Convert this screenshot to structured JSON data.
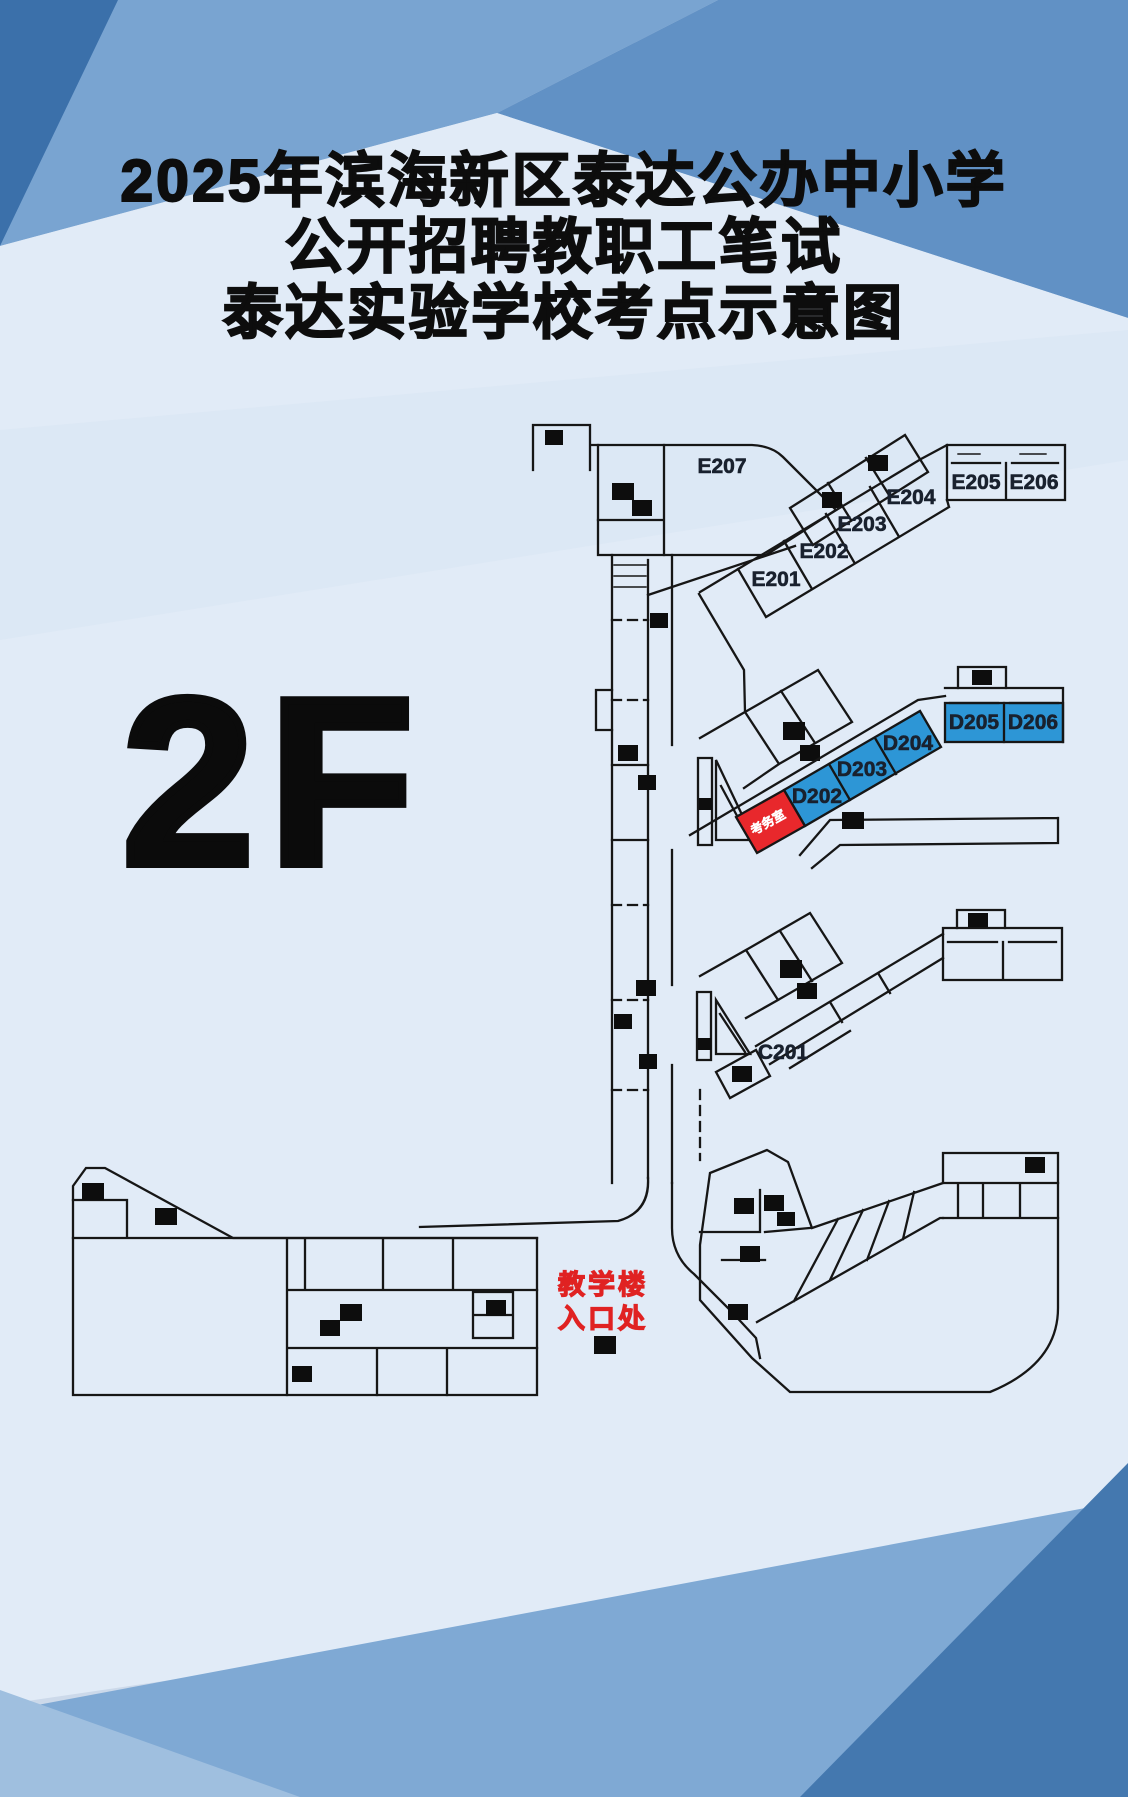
{
  "title": {
    "line1": "2025年滨海新区泰达公办中小学",
    "line2": "公开招聘教职工笔试",
    "line3": "泰达实验学校考点示意图"
  },
  "floor": {
    "label": "2F"
  },
  "map": {
    "rooms": {
      "e201": "E201",
      "e202": "E202",
      "e203": "E203",
      "e204": "E204",
      "e205": "E205",
      "e206": "E206",
      "e207": "E207",
      "c201": "C201",
      "d202": "D202",
      "d203": "D203",
      "d204": "D204",
      "d205": "D205",
      "d206": "D206"
    },
    "exam_office_label": "考务室",
    "entrance": {
      "line1": "教学楼",
      "line2": "入口处"
    }
  },
  "colors": {
    "highlight_room": "#2d96d6",
    "exam_office_room": "#e8282c",
    "entrance_text": "#e02222",
    "wall": "#161616",
    "background": "#ccd9ea",
    "light_area": "#e1ebf7",
    "band_top_left": "#79a4d1",
    "band_top_right": "#6191c5",
    "corner_dark": "#3b70aa",
    "band_bottom": "#7fa9d4",
    "corner_bottom_right": "#4478af"
  }
}
